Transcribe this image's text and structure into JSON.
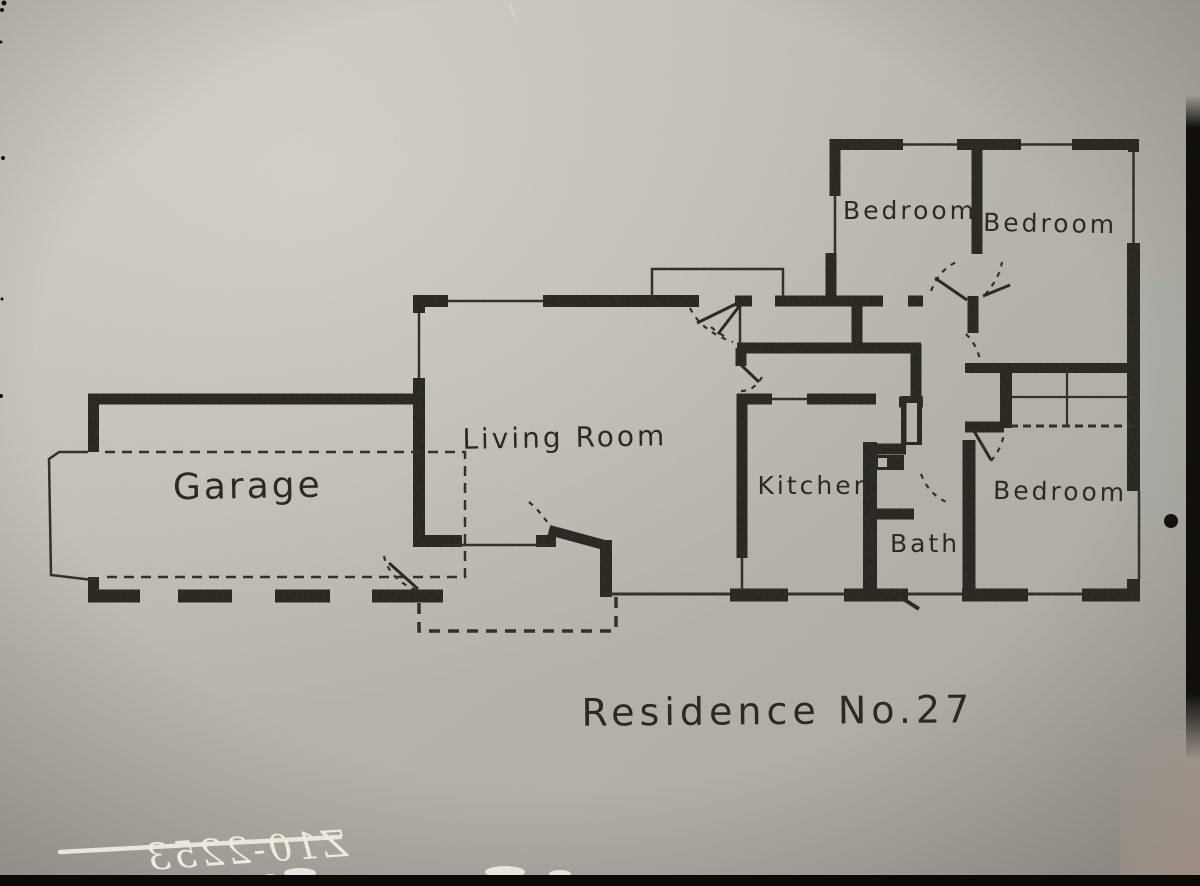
{
  "plan": {
    "title": "Residence No.27",
    "rooms": {
      "garage": {
        "label": "Garage"
      },
      "living_room": {
        "label": "Living Room"
      },
      "kitchen": {
        "label": "Kitchen"
      },
      "bath": {
        "label": "Bath"
      },
      "bedroom_top_left": {
        "label": "Bedroom"
      },
      "bedroom_top_right": {
        "label": "Bedroom"
      },
      "bedroom_bottom_right": {
        "label": "Bedroom"
      }
    },
    "negative_marking": {
      "text": "Z10-2253",
      "mirrored": true,
      "struck_through": true
    }
  },
  "colors": {
    "paper_gray": "#b6b4ac",
    "paper_highlight": "#c9c7be",
    "ink_black": "#1d1b15",
    "film_edge_black": "#0a0a09",
    "marking_white": "#edeadf"
  }
}
